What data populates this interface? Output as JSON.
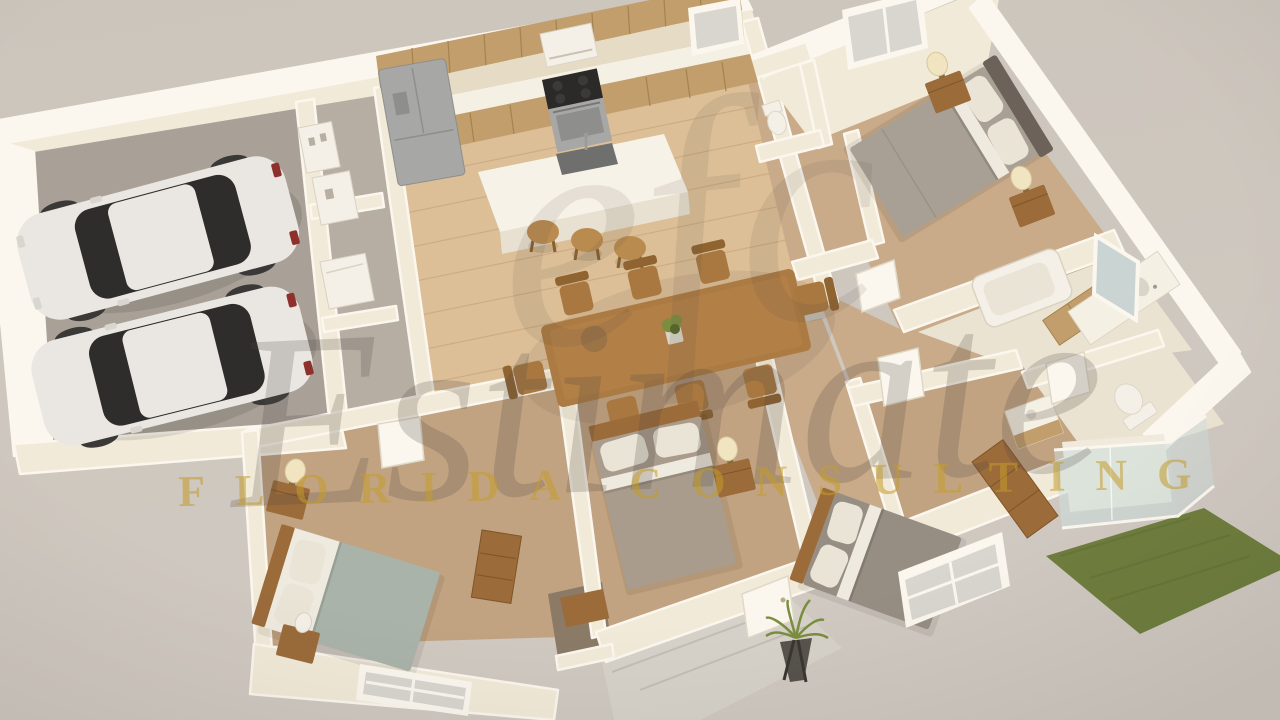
{
  "watermark": {
    "monogram": "efc",
    "title": "Estimate",
    "subtitle": "FLORIDA CONSULTING"
  },
  "colors": {
    "bg": "#c8c0b6",
    "bgTop": "#ccc5bc",
    "bgBottom": "#d0c9c1",
    "wall": "#f2ead8",
    "wallTop": "#fbf7ee",
    "wallShade": "#e6dbc4",
    "woodFloor": "#dcbf97",
    "woodLine": "#c19d72",
    "carpet": "#c9ab8a",
    "carpetBottom": "#c2a381",
    "garageFloor": "#a9a197",
    "tileGray": "#b6aea3",
    "bathTile": "#ebe3d2",
    "entryTile": "#d7d2c9",
    "grass": "#6f7e3e",
    "grassDark": "#5f6e33",
    "cabinet": "#c19e6c",
    "cabinetLine": "#a5834f",
    "counter": "#f5f0e4",
    "steel": "#a7a7a6",
    "steelDark": "#87878a",
    "island": "#f7f2e7",
    "islandSide": "#e8e1d1",
    "sinkColor": "#6f6f6d",
    "tableWood": "#ab7b43",
    "chairWood": "#a87840",
    "chairWoodDark": "#8f6430",
    "stoolWood": "#ba8b4f",
    "bedGray": "#a9a095",
    "bedSage": "#aab3aa",
    "bedTaupe": "#a99c8c",
    "bedGray2": "#968e83",
    "pillow": "#eae4d6",
    "sheet": "#efeadf",
    "headboard": "#6c6259",
    "woodFurn": "#9b6b3a",
    "woodFurnDark": "#7f5527",
    "lamp": "#f0e4c1",
    "white": "#f4f0e7",
    "glassColor": "#ccdcdb",
    "mirror": "#c9d4d3",
    "windowGlass": "#d9d6cf",
    "plantGreen": "#7b8d3f",
    "plantDark": "#57682c",
    "carBody": "#eae7e2",
    "carGlass": "#2f2d2b",
    "wheelColor": "#3b3937",
    "tailRed": "#8e302b",
    "wmScript": "#4f4742",
    "wmGold": "#c59c2b"
  }
}
